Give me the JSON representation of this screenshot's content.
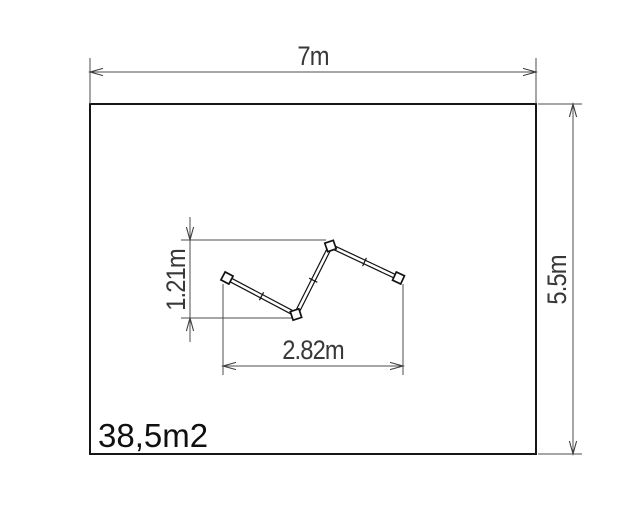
{
  "plan": {
    "area_label": "38,5m2",
    "dimensions": {
      "site_width": "7m",
      "site_height": "5.5m",
      "equipment_width": "2.82m",
      "equipment_height": "1.21m"
    },
    "colors": {
      "background": "#ffffff",
      "boundary_outline": "#161616",
      "dimension_lines": "#4e4e4e",
      "dimension_text": "#383838",
      "area_text": "#101010"
    }
  }
}
